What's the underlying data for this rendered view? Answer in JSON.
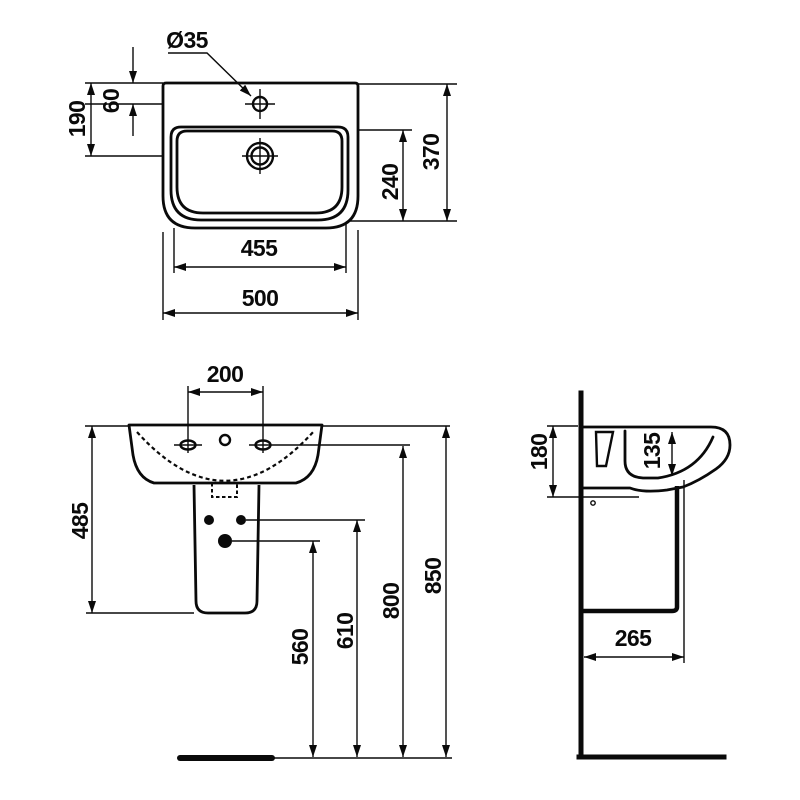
{
  "page": {
    "background": "#ffffff",
    "line_color": "#0a0a0a",
    "content": "washbasin with pedestal technical dimension drawing, three views"
  },
  "top_view": {
    "tap_hole_label": "Ø35",
    "dims": {
      "tap_offset_from_rear": "60",
      "drain_offset_from_rear": "190",
      "inner_depth": "240",
      "overall_depth": "370",
      "inner_width": "455",
      "overall_width": "500"
    }
  },
  "front_view": {
    "dims": {
      "fixing_hole_spacing": "200",
      "rim_to_pedestal_bottom": "485",
      "outlet_height": "560",
      "pedestal_holes_height": "610",
      "fixing_holes_height": "800",
      "rim_height": "850"
    }
  },
  "side_view": {
    "dims": {
      "apron_depth": "180",
      "bowl_inner_depth": "135",
      "outlet_distance_from_wall": "265"
    }
  }
}
